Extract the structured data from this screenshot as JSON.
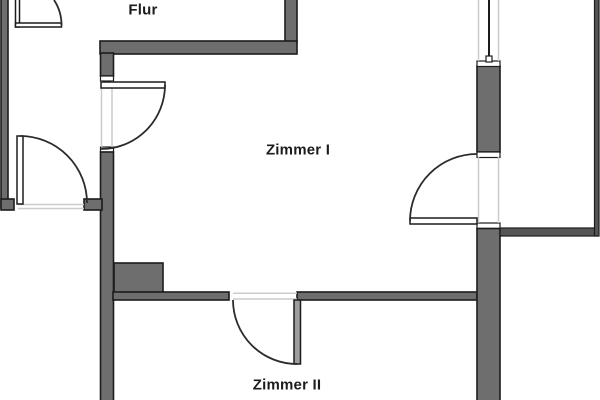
{
  "plan": {
    "rooms": [
      {
        "id": "flur",
        "label": "Flur"
      },
      {
        "id": "zimmer-1",
        "label": "Zimmer I"
      },
      {
        "id": "zimmer-2",
        "label": "Zimmer II"
      }
    ]
  },
  "colors": {
    "background": "#ffffff",
    "wall_fill": "#6e6e6e",
    "wall_outline": "#1c1c1c",
    "balcony_wall_fill": "#555555",
    "opening_line": "#cccccc",
    "door_arc": "#2b2b2b",
    "door_leaf_fill": "#ffffff",
    "door_leaf_gray": "#9e9e9e",
    "label_text": "#1c1c1c"
  }
}
